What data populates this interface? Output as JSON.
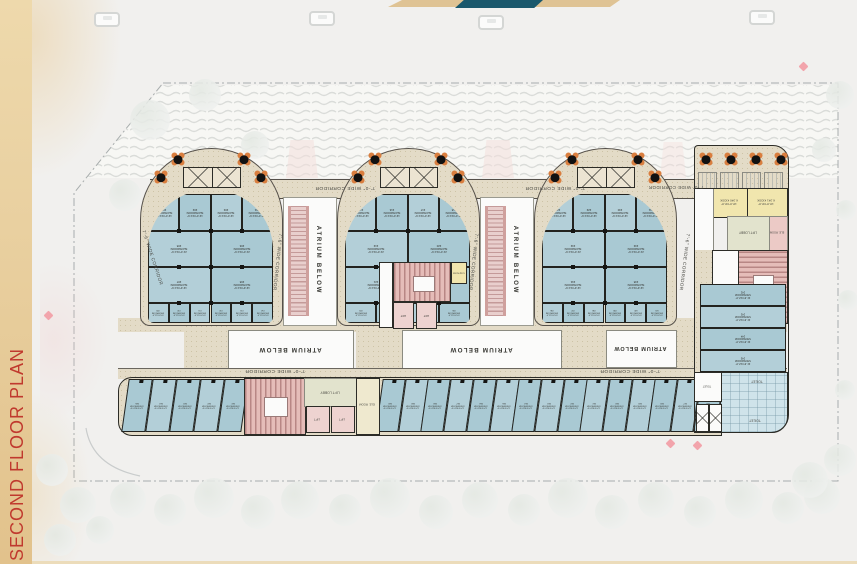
{
  "page": {
    "title": "SECOND FLOOR PLAN"
  },
  "labels": {
    "corridor_h": "7'-0\" WIDE CORRIDOR",
    "corridor_v": "7'-6\" WIDE CORRIDOR",
    "atrium": "ATRIUM BELOW",
    "toilet": "TOILET",
    "lift": "LIFT",
    "lift_lobby": "LIFT LOBBY",
    "ele_room": "ELE. ROOM",
    "showroom": "SHOWROOM"
  },
  "dims": {
    "a": "12'-0\"X13'-6\"",
    "b": "21'-0\"X14'-6\"",
    "c": "12'-6\"X14'-6\"",
    "d": "10'-0\"X11'-0\"",
    "wing": "21'-6\"X12'-0\"",
    "bottom": "12'-0\"X21'-6\""
  },
  "kiosks": [
    {
      "code": "K.340 KIOSK",
      "dims": "10'-0\"X9'-8\""
    },
    {
      "code": "K.341 KIOSK",
      "dims": "13'-8\"X9'-8\""
    },
    {
      "code": "K.342 KIOSK",
      "dims": "7'-0\"X9'-0\""
    }
  ],
  "pods": [
    {
      "name": "pod-1",
      "rows": {
        "a": [
          "201",
          "202",
          "203",
          "204"
        ],
        "b": [
          "205",
          "206"
        ],
        "c": [
          "207",
          "208"
        ],
        "d": [
          "209",
          "210",
          "211",
          "212",
          "213",
          "214"
        ]
      }
    },
    {
      "name": "pod-2",
      "rows": {
        "a": [
          "215",
          "216",
          "217",
          "218"
        ],
        "b": [
          "219",
          "220"
        ],
        "c": [
          "221",
          "222"
        ],
        "d": [
          "223",
          "224",
          "225",
          "226"
        ]
      }
    },
    {
      "name": "pod-3",
      "rows": {
        "a": [
          "228",
          "229",
          "230",
          "231"
        ],
        "b": [
          "232",
          "233"
        ],
        "c": [
          "234",
          "235"
        ],
        "d": [
          "236",
          "237",
          "238",
          "239",
          "240",
          "241"
        ]
      }
    }
  ],
  "wing": {
    "column": [
      "242",
      "243",
      "244",
      "245"
    ]
  },
  "bottom_row": {
    "left": [
      "265",
      "264",
      "263",
      "262",
      "261"
    ],
    "middle": [
      "260",
      "259",
      "258",
      "257",
      "256",
      "255",
      "254",
      "253",
      "252",
      "251",
      "250",
      "249",
      "248",
      "247",
      "246"
    ]
  },
  "colors": {
    "sidebar": "#e9d0a0",
    "title": "#c0392e",
    "teal": "#1a586c",
    "gold": "#dfc394",
    "corridor": "#e3dbc7",
    "wall": "#2c2c27",
    "showroom": "#a9c9d3",
    "showroom_alt": "#b3cfd8",
    "stair": "#e5bcb8",
    "lift": "#eed3d0",
    "kiosk": "#f1e6ae",
    "toilet": "#cfe3ea",
    "lobby": "#e2e3cd",
    "ele": "#eccac6",
    "boundary": "#a8adad",
    "chair_orange": "#d97e3f",
    "table_black": "#111111"
  }
}
